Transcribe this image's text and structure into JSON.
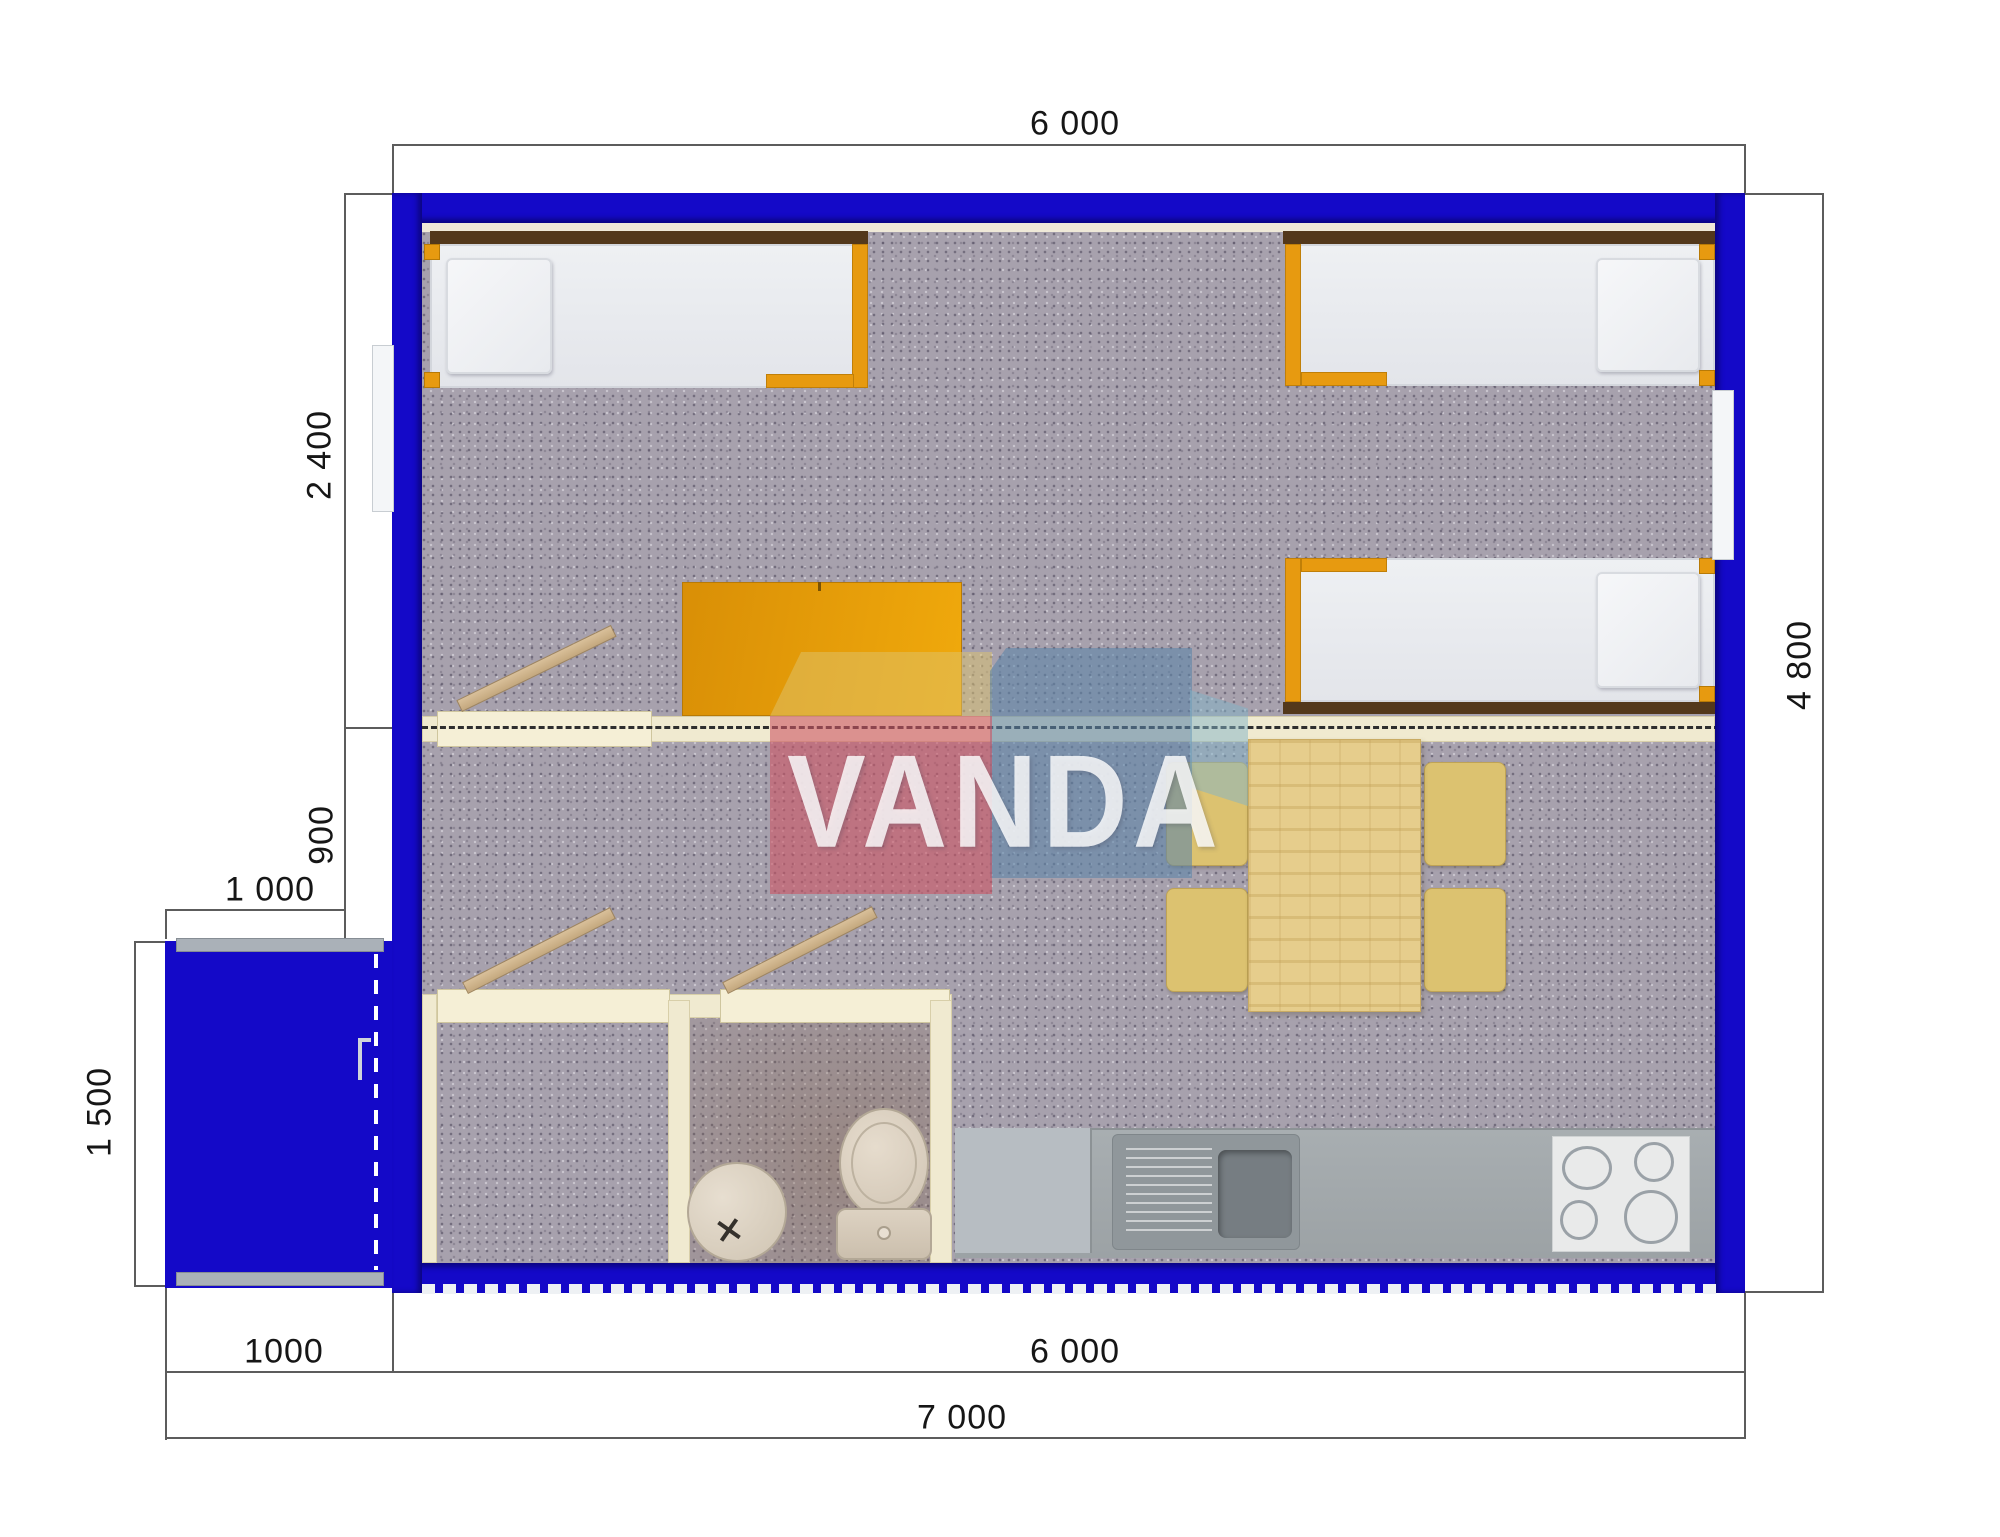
{
  "logo": {
    "text": "VANDA"
  },
  "dimensions": {
    "top_width": "6 000",
    "bedroom_depth": "2 400",
    "hall_depth": "900",
    "porch_width": "1 000",
    "porch_depth": "1 500",
    "bottom_porch_width": "1000",
    "bottom_main_width": "6 000",
    "bottom_total_width": "7 000",
    "main_depth": "4 800"
  },
  "colors": {
    "wall_blue": "#1409c8",
    "frame_orange": "#e79a10",
    "partition_cream": "#f0ead0",
    "floor_carpet": "#a7a1ad",
    "counter_gray": "#a2a8ab",
    "table_wood": "#e6cd8c",
    "logo_red": "#cd5564",
    "logo_blue": "#5c84a8",
    "dimension_line": "#5c5c5c"
  }
}
